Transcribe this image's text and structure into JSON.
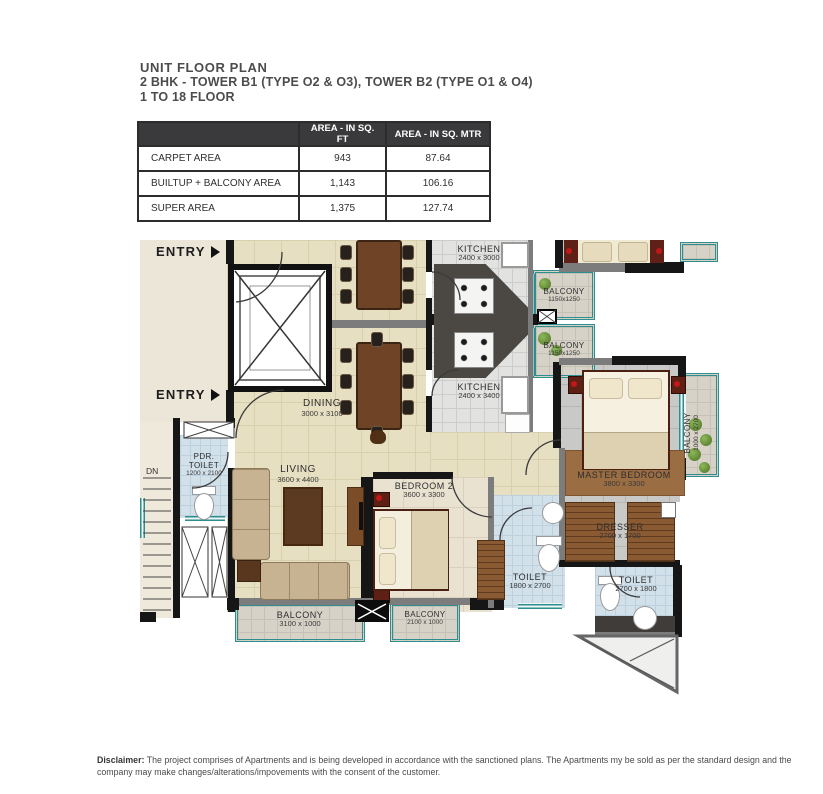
{
  "colors": {
    "accent_teal": "#2e8d8f",
    "wall_black": "#161616",
    "floor_beige": "#e7dfc2",
    "toilet_blue": "#d2e0ea",
    "table_header_bg": "#3a393b",
    "title_text": "#4c4c4c"
  },
  "header": {
    "line1": "UNIT FLOOR PLAN",
    "line2": "2 BHK - TOWER B1 (TYPE O2 & O3), TOWER B2 (TYPE O1 & O4)",
    "line3": "1 TO 18 FLOOR"
  },
  "area_table": {
    "header": {
      "col1": "AREA - IN SQ. FT",
      "col2": "AREA - IN SQ. MTR"
    },
    "rows": [
      {
        "label": "CARPET AREA",
        "sqft": "943",
        "sqmtr": "87.64"
      },
      {
        "label": "BUILTUP + BALCONY AREA",
        "sqft": "1,143",
        "sqmtr": "106.16"
      },
      {
        "label": "SUPER AREA",
        "sqft": "1,375",
        "sqmtr": "127.74"
      }
    ]
  },
  "plan": {
    "entry": "ENTRY",
    "dn": "DN",
    "kitchen_top": {
      "name": "KITCHEN",
      "dim": "2400 x 3000"
    },
    "kitchen_main": {
      "name": "KITCHEN",
      "dim": "2400 x 3400"
    },
    "balcony_top": {
      "name": "BALCONY",
      "dim": "1150x1250"
    },
    "balcony_mid": {
      "name": "BALCONY",
      "dim": "1150x1250"
    },
    "dining": {
      "name": "DINING",
      "dim": "3000 x 3100"
    },
    "living": {
      "name": "LIVING",
      "dim": "3600 x 4400"
    },
    "bedroom2": {
      "name": "BEDROOM 2",
      "dim": "3600 x 3300"
    },
    "master_bedroom": {
      "name": "MASTER BEDROOM",
      "dim": "3800 x 3300"
    },
    "balcony_right": {
      "name": "BALCONY",
      "dim": "1000 x 2700"
    },
    "dresser": {
      "name": "DRESSER",
      "dim": "2700 x 1700"
    },
    "toilet_1": {
      "name": "TOILET",
      "dim": "1800 x 2700"
    },
    "toilet_2": {
      "name": "TOILET",
      "dim": "2700 x 1800"
    },
    "pdr_toilet": {
      "line1": "PDR.",
      "line2": "TOILET",
      "dim": "1200 x 2100"
    },
    "balcony_bottom_left": {
      "name": "BALCONY",
      "dim": "3100 x 1000"
    },
    "balcony_bottom_right": {
      "name": "BALCONY",
      "dim": "2100 x 1000"
    }
  },
  "disclaimer": {
    "label": "Disclaimer:",
    "text": "The project comprises of Apartments and is being developed in accordance with the sanctioned plans. The Apartments my be sold as per the standard design and the company may make changes/alterations/impovements with the consent of the customer."
  }
}
